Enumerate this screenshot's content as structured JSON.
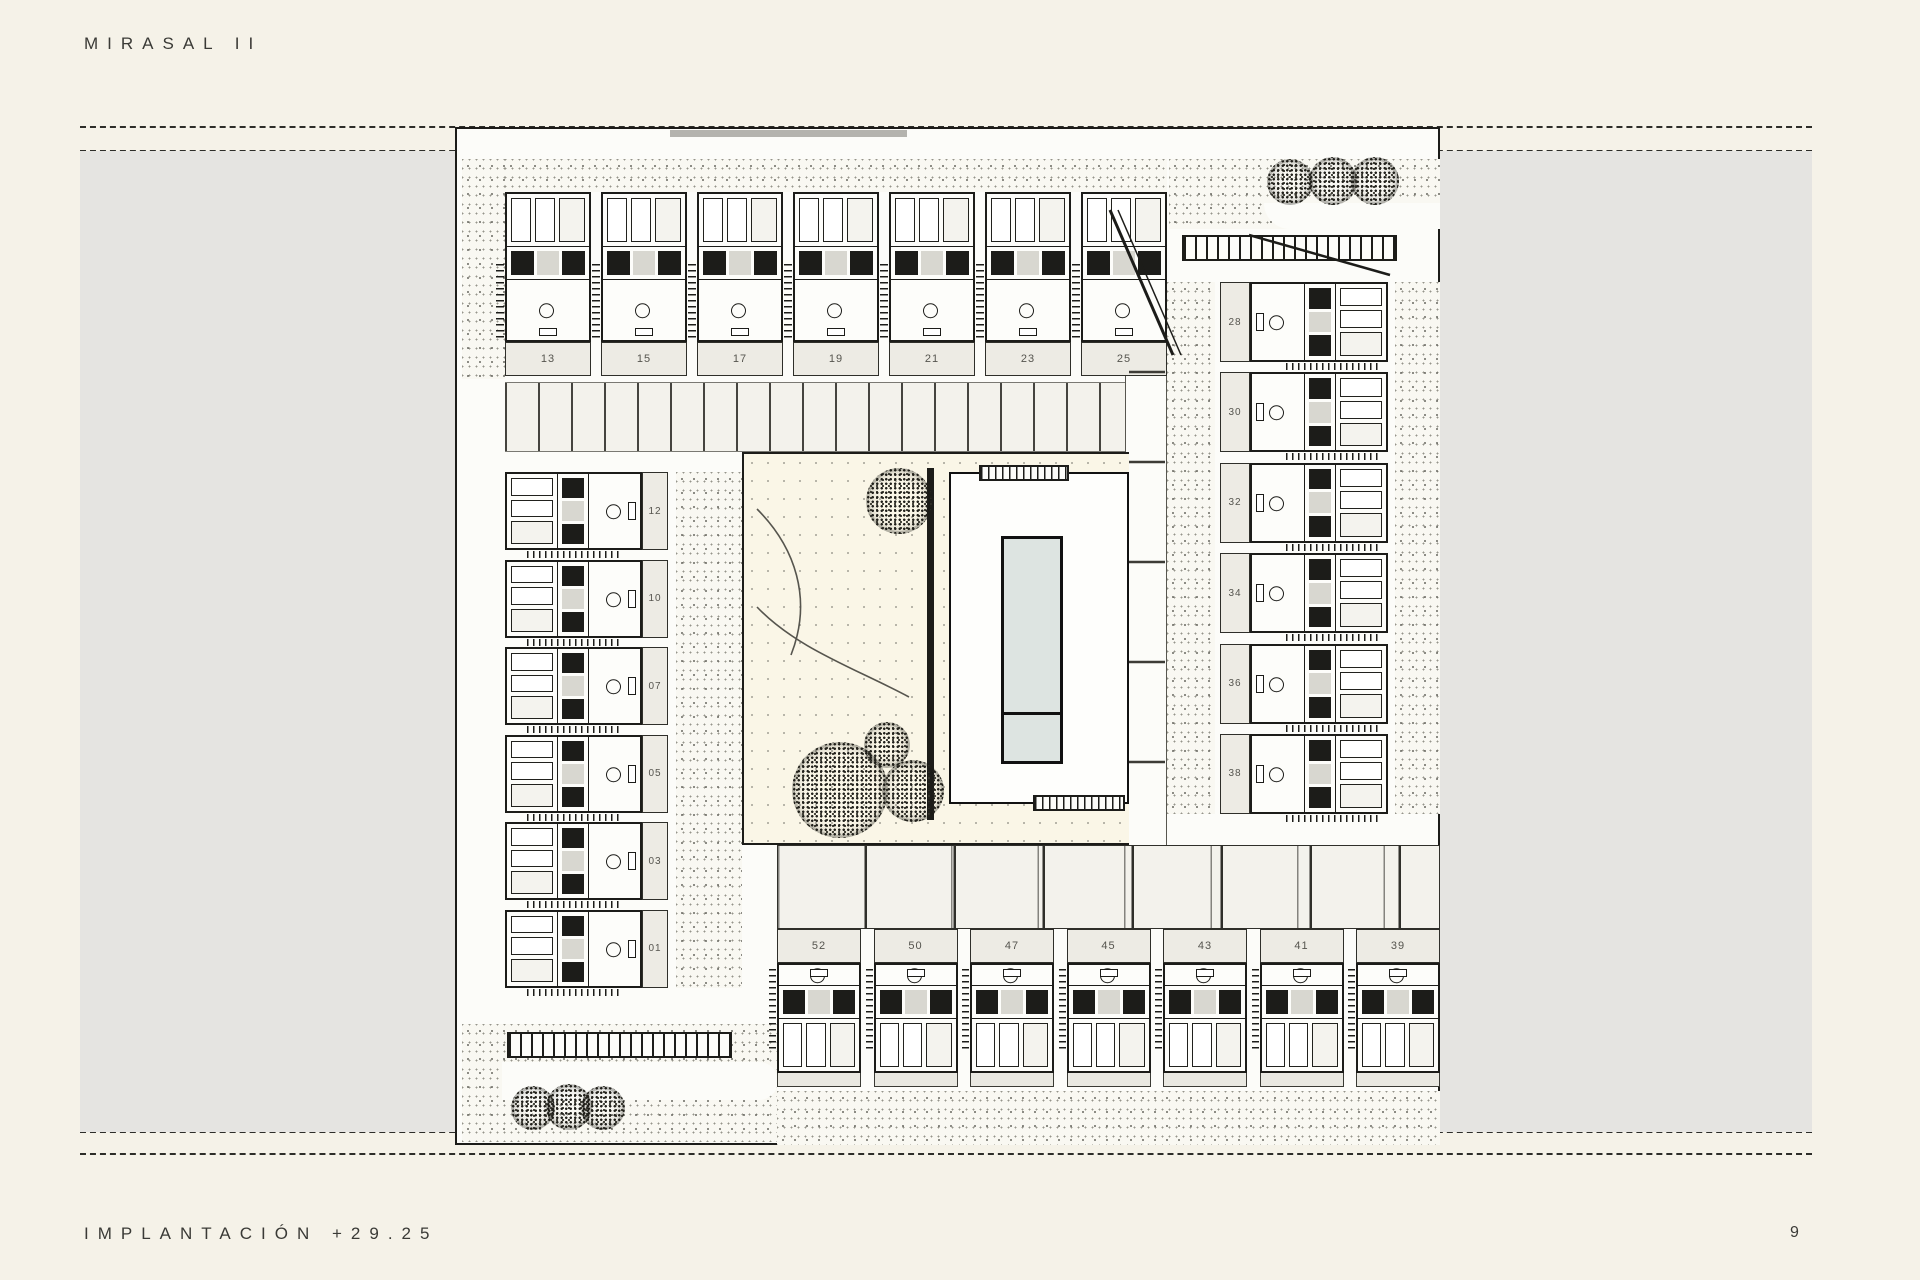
{
  "page": {
    "title": "MIRASAL II",
    "footer_label": "IMPLANTACIÓN +29.25",
    "page_number": "9"
  },
  "plan": {
    "top_row": {
      "numbers": [
        "13",
        "15",
        "17",
        "19",
        "21",
        "23",
        "25"
      ]
    },
    "right_col": {
      "numbers": [
        "28",
        "30",
        "32",
        "34",
        "36",
        "38"
      ]
    },
    "left_col": {
      "numbers": [
        "12",
        "10",
        "07",
        "05",
        "03",
        "01"
      ]
    },
    "bottom_row": {
      "numbers": [
        "52",
        "50",
        "47",
        "45",
        "43",
        "41",
        "39"
      ]
    },
    "features": {
      "pool": "swimming-pool",
      "trees_top_right": 3,
      "trees_bottom_left": 3,
      "trees_courtyard": 4
    }
  },
  "colors": {
    "page_bg": "#f5f2e8",
    "paper_gray": "#e5e4e1",
    "plan_bg": "#fcfcf9",
    "ink": "#1c1c19",
    "court_bg": "#faf6e7",
    "pool": "#dde4e1",
    "cell_bg": "#edebe4"
  }
}
